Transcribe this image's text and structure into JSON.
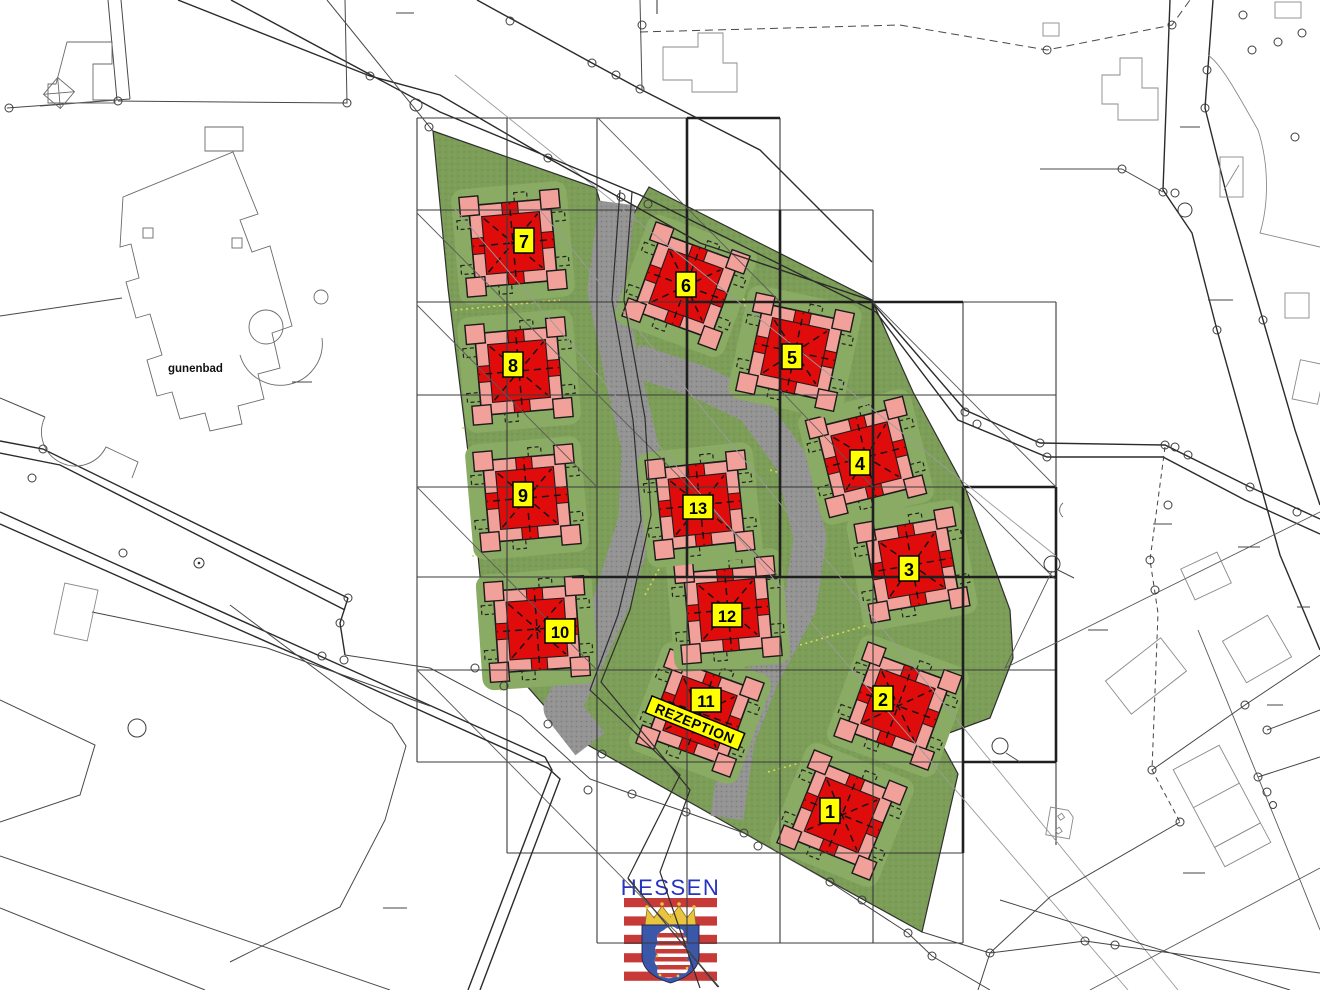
{
  "map": {
    "type": "cadastral-site-plan",
    "area_label": "gunenbad",
    "reception_label": "REZEPTION",
    "buildings": [
      {
        "number": "1"
      },
      {
        "number": "2"
      },
      {
        "number": "3"
      },
      {
        "number": "4"
      },
      {
        "number": "5"
      },
      {
        "number": "6"
      },
      {
        "number": "7"
      },
      {
        "number": "8"
      },
      {
        "number": "9"
      },
      {
        "number": "10"
      },
      {
        "number": "11"
      },
      {
        "number": "12"
      },
      {
        "number": "13"
      }
    ],
    "building_count": 13,
    "colors": {
      "site_green": "#7d9e58",
      "lawn_green": "#8aab63",
      "path_gray": "#949494",
      "building_red": "#e00c0c",
      "building_pink": "#f2a09a",
      "label_yellow": "#ffff00",
      "line_dark": "#1f1f1f"
    }
  },
  "logo": {
    "region_name": "HESSEN",
    "colors": {
      "text_blue": "#2433c0",
      "flag_red": "#c63a38",
      "shield_blue": "#3b57a8",
      "crown_gold": "#e9c53f"
    }
  }
}
